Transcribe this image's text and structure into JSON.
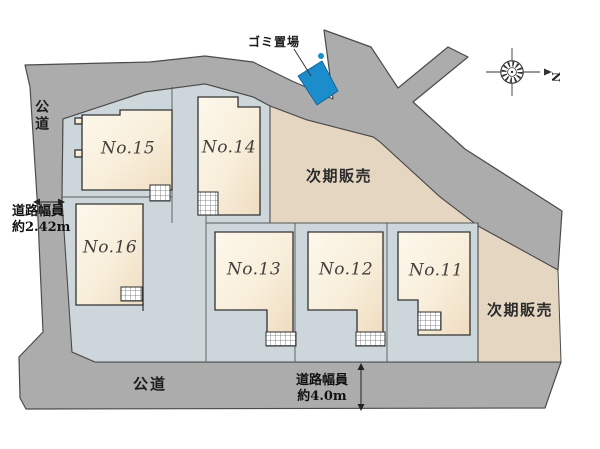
{
  "plan": {
    "title_hint": "residential lot site plan",
    "garbage_station": {
      "label": "ゴミ置場"
    },
    "compass": {
      "north_label": "N"
    },
    "roads": {
      "left": {
        "label": "公道",
        "width_note": "道路幅員\n約2.42m"
      },
      "bottom": {
        "label": "公道",
        "width_note": "道路幅員\n約4.0m"
      }
    },
    "sale_areas": [
      {
        "label": "次期販売"
      },
      {
        "label": "次期販売"
      }
    ],
    "houses": [
      {
        "label": "No.15"
      },
      {
        "label": "No.14"
      },
      {
        "label": "No.16"
      },
      {
        "label": "No.13"
      },
      {
        "label": "No.12"
      },
      {
        "label": "No.11"
      }
    ],
    "colors": {
      "road": "#acacac",
      "road_outline": "#4b4b4b",
      "residential_block": "#cdd7db",
      "sale_area": "#e4d6c1",
      "house_fill": "#f7ecd8",
      "garbage_station": "#1b8dcd"
    }
  }
}
